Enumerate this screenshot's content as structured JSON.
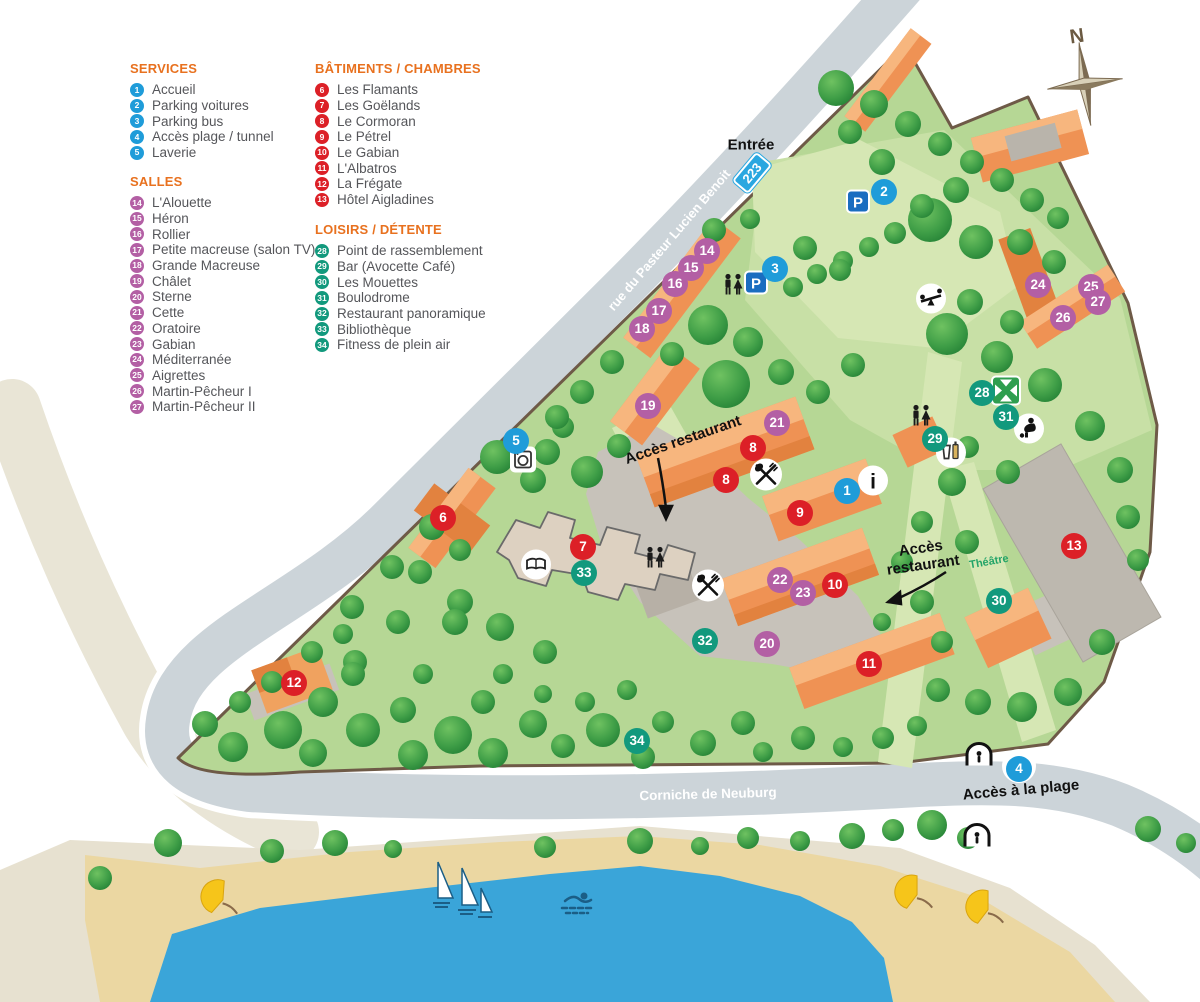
{
  "legend": {
    "sections": [
      {
        "id": "services",
        "title": "SERVICES",
        "items": [
          {
            "num": "1",
            "label": "Accueil"
          },
          {
            "num": "2",
            "label": "Parking voitures"
          },
          {
            "num": "3",
            "label": "Parking bus"
          },
          {
            "num": "4",
            "label": "Accès plage / tunnel"
          },
          {
            "num": "5",
            "label": "Laverie"
          }
        ]
      },
      {
        "id": "salles",
        "title": "SALLES",
        "items": [
          {
            "num": "14",
            "label": "L'Alouette"
          },
          {
            "num": "15",
            "label": "Héron"
          },
          {
            "num": "16",
            "label": "Rollier"
          },
          {
            "num": "17",
            "label": "Petite macreuse (salon TV)"
          },
          {
            "num": "18",
            "label": "Grande Macreuse"
          },
          {
            "num": "19",
            "label": "Châlet"
          },
          {
            "num": "20",
            "label": "Sterne"
          },
          {
            "num": "21",
            "label": "Cette"
          },
          {
            "num": "22",
            "label": "Oratoire"
          },
          {
            "num": "23",
            "label": "Gabian"
          },
          {
            "num": "24",
            "label": "Méditerranée"
          },
          {
            "num": "25",
            "label": "Aigrettes"
          },
          {
            "num": "26",
            "label": "Martin-Pêcheur I"
          },
          {
            "num": "27",
            "label": "Martin-Pêcheur II"
          }
        ]
      },
      {
        "id": "batiments",
        "title": "BÂTIMENTS / CHAMBRES",
        "items": [
          {
            "num": "6",
            "label": "Les Flamants"
          },
          {
            "num": "7",
            "label": "Les Goëlands"
          },
          {
            "num": "8",
            "label": "Le Cormoran"
          },
          {
            "num": "9",
            "label": "Le Pétrel"
          },
          {
            "num": "10",
            "label": "Le Gabian"
          },
          {
            "num": "11",
            "label": "L'Albatros"
          },
          {
            "num": "12",
            "label": "La Frégate"
          },
          {
            "num": "13",
            "label": "Hôtel Aigladines"
          }
        ]
      },
      {
        "id": "loisirs",
        "title": "LOISIRS / DÉTENTE",
        "items": [
          {
            "num": "28",
            "label": "Point de rassemblement"
          },
          {
            "num": "29",
            "label": "Bar (Avocette Café)"
          },
          {
            "num": "30",
            "label": "Les Mouettes"
          },
          {
            "num": "31",
            "label": "Boulodrome"
          },
          {
            "num": "32",
            "label": "Restaurant panoramique"
          },
          {
            "num": "33",
            "label": "Bibliothèque"
          },
          {
            "num": "34",
            "label": "Fitness de plein air"
          }
        ]
      }
    ]
  },
  "map": {
    "labels": {
      "entree": "Entrée",
      "route_number": "223",
      "street": "rue du Pasteur Lucien Benoit",
      "acces_restaurant_1": "Accès restaurant",
      "acces_restaurant_2": "Accès restaurant",
      "theatre": "Théâtre",
      "corniche": "Corniche de Neuburg",
      "acces_plage": "Accès à la plage",
      "compass_north": "N"
    },
    "colors": {
      "services": "#1f9cd9",
      "salles": "#b35fa4",
      "batiments": "#dc2027",
      "loisirs": "#12997d",
      "legend_header": "#e8711f",
      "route_badge": "#2aa7e0"
    },
    "markers": [
      {
        "num": "1",
        "type": "services",
        "x": 847,
        "y": 491
      },
      {
        "num": "2",
        "type": "services",
        "x": 884,
        "y": 192
      },
      {
        "num": "3",
        "type": "services",
        "x": 775,
        "y": 269
      },
      {
        "num": "4",
        "type": "services",
        "x": 1019,
        "y": 769
      },
      {
        "num": "5",
        "type": "services",
        "x": 516,
        "y": 441
      },
      {
        "num": "6",
        "type": "batiments",
        "x": 443,
        "y": 518
      },
      {
        "num": "7",
        "type": "batiments",
        "x": 583,
        "y": 547
      },
      {
        "num": "8",
        "type": "batiments",
        "x": 753,
        "y": 448
      },
      {
        "num": "8",
        "type": "batiments",
        "x": 726,
        "y": 480
      },
      {
        "num": "9",
        "type": "batiments",
        "x": 800,
        "y": 513
      },
      {
        "num": "10",
        "type": "batiments",
        "x": 835,
        "y": 585
      },
      {
        "num": "11",
        "type": "batiments",
        "x": 869,
        "y": 664
      },
      {
        "num": "12",
        "type": "batiments",
        "x": 294,
        "y": 683
      },
      {
        "num": "13",
        "type": "batiments",
        "x": 1074,
        "y": 546
      },
      {
        "num": "14",
        "type": "salles",
        "x": 707,
        "y": 251
      },
      {
        "num": "15",
        "type": "salles",
        "x": 691,
        "y": 268
      },
      {
        "num": "16",
        "type": "salles",
        "x": 675,
        "y": 284
      },
      {
        "num": "17",
        "type": "salles",
        "x": 659,
        "y": 311
      },
      {
        "num": "18",
        "type": "salles",
        "x": 642,
        "y": 329
      },
      {
        "num": "19",
        "type": "salles",
        "x": 648,
        "y": 406
      },
      {
        "num": "20",
        "type": "salles",
        "x": 767,
        "y": 644
      },
      {
        "num": "21",
        "type": "salles",
        "x": 777,
        "y": 423
      },
      {
        "num": "22",
        "type": "salles",
        "x": 780,
        "y": 580
      },
      {
        "num": "23",
        "type": "salles",
        "x": 803,
        "y": 593
      },
      {
        "num": "24",
        "type": "salles",
        "x": 1038,
        "y": 285
      },
      {
        "num": "25",
        "type": "salles",
        "x": 1091,
        "y": 287
      },
      {
        "num": "26",
        "type": "salles",
        "x": 1063,
        "y": 318
      },
      {
        "num": "27",
        "type": "salles",
        "x": 1098,
        "y": 302
      },
      {
        "num": "28",
        "type": "loisirs",
        "x": 982,
        "y": 393
      },
      {
        "num": "29",
        "type": "loisirs",
        "x": 935,
        "y": 439
      },
      {
        "num": "30",
        "type": "loisirs",
        "x": 999,
        "y": 601
      },
      {
        "num": "31",
        "type": "loisirs",
        "x": 1006,
        "y": 417
      },
      {
        "num": "32",
        "type": "loisirs",
        "x": 705,
        "y": 641
      },
      {
        "num": "33",
        "type": "loisirs",
        "x": 584,
        "y": 573
      },
      {
        "num": "34",
        "type": "loisirs",
        "x": 637,
        "y": 741
      }
    ],
    "icons": [
      {
        "name": "parking-icon",
        "x": 858,
        "y": 204
      },
      {
        "name": "parking-icon",
        "x": 756,
        "y": 285
      },
      {
        "name": "wc-icon",
        "x": 733,
        "y": 287
      },
      {
        "name": "wc-icon",
        "x": 655,
        "y": 560
      },
      {
        "name": "wc-icon",
        "x": 921,
        "y": 418
      },
      {
        "name": "restaurant-icon",
        "x": 766,
        "y": 477
      },
      {
        "name": "restaurant-icon",
        "x": 708,
        "y": 588
      },
      {
        "name": "info-icon",
        "x": 873,
        "y": 483
      },
      {
        "name": "laundry-icon",
        "x": 523,
        "y": 462
      },
      {
        "name": "book-icon",
        "x": 536,
        "y": 567
      },
      {
        "name": "bar-icon",
        "x": 951,
        "y": 455
      },
      {
        "name": "petanque-icon",
        "x": 1029,
        "y": 431
      },
      {
        "name": "playground-icon",
        "x": 931,
        "y": 301
      },
      {
        "name": "assembly-point-icon",
        "x": 1006,
        "y": 393
      },
      {
        "name": "tunnel-icon",
        "x": 979,
        "y": 757
      },
      {
        "name": "tunnel-icon",
        "x": 977,
        "y": 838
      }
    ]
  }
}
